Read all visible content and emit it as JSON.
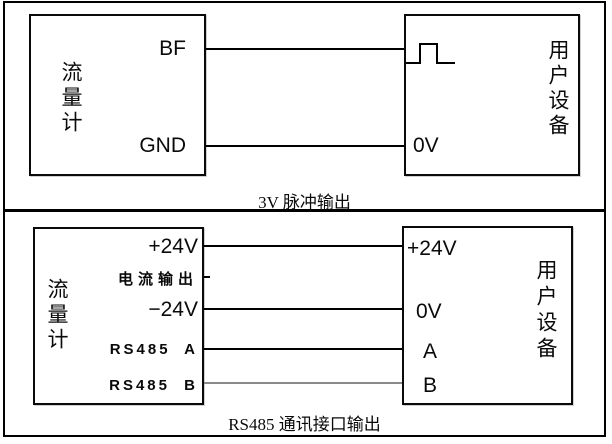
{
  "colors": {
    "line": "#000000",
    "faint_line": "#8a8a8a",
    "text": "#000000",
    "background": "#ffffff"
  },
  "pulse_output": {
    "caption": "3V 脉冲输出",
    "flowmeter": {
      "title": "流量计",
      "pins": {
        "bf": "BF",
        "gnd": "GND"
      }
    },
    "device": {
      "title": "用户设备",
      "pulse_icon": "square-pulse-waveform",
      "pins": {
        "ov": "0V"
      }
    }
  },
  "rs485_output": {
    "caption": "RS485 通讯接口输出",
    "flowmeter": {
      "title": "流量计",
      "pins": {
        "p24": "+24V",
        "current": "电流输出",
        "n24": "−24V",
        "rs485a": "RS485 A",
        "rs485b": "RS485 B"
      }
    },
    "device": {
      "title": "用户设备",
      "pins": {
        "p24": "+24V",
        "ov": "0V",
        "a": "A",
        "b": "B"
      }
    }
  }
}
